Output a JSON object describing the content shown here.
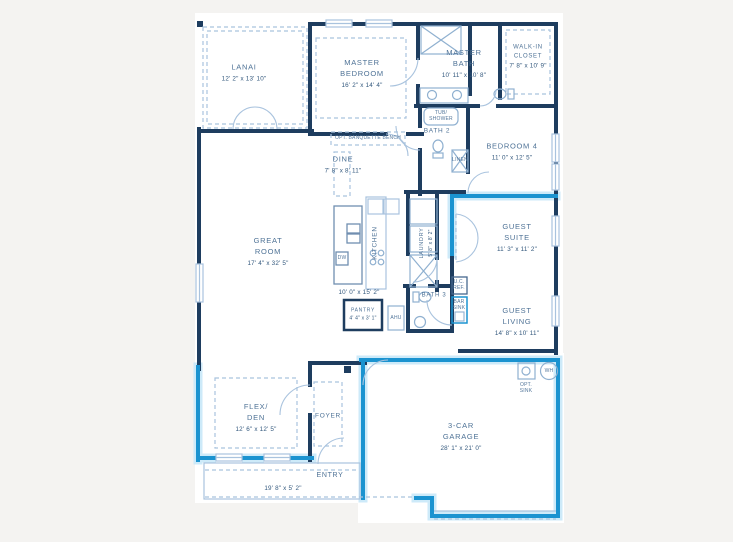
{
  "title": "Floor plan",
  "colors": {
    "wall": "#1e3d5f",
    "optional_wall_accent": "#1b93d0",
    "optional_wall_halo": "#cdeaf9",
    "detail_line": "#a9c3de",
    "room_text": "#4e7296",
    "dims_text": "#33587d",
    "page_background": "#f4f3f1",
    "paper": "#ffffff"
  },
  "rooms": {
    "lanai": {
      "name": "LANAI",
      "dims": "12' 2\" x 13' 10\""
    },
    "master_bedroom": {
      "name": "MASTER\nBEDROOM",
      "dims": "16' 2\" x 14' 4\""
    },
    "master_bath": {
      "name": "MASTER\nBATH",
      "dims": "10' 11\" x 10' 8\""
    },
    "walk_in_closet": {
      "name": "WALK-IN\nCLOSET",
      "dims": "7' 8\" x 10' 9\""
    },
    "bath2": {
      "name": "BATH 2"
    },
    "bedroom4": {
      "name": "BEDROOM 4",
      "dims": "11' 0\" x 12' 5\""
    },
    "dine": {
      "name": "DINE",
      "dims": "7' 8\" x 8' 11\""
    },
    "great_room": {
      "name": "GREAT\nROOM",
      "dims": "17' 4\" x 32' 5\""
    },
    "kitchen": {
      "name": "KITCHEN",
      "dims": "10' 0\" x 15' 2\""
    },
    "laundry": {
      "name": "LAUNDRY",
      "dims": "5' 8\" x 8' 2\""
    },
    "guest_suite": {
      "name": "GUEST\nSUITE",
      "dims": "11' 3\" x 11' 2\""
    },
    "guest_living": {
      "name": "GUEST\nLIVING",
      "dims": "14' 8\" x 10' 11\""
    },
    "bath3": {
      "name": "BATH 3"
    },
    "pantry": {
      "name": "PANTRY",
      "dims": "4' 4\" x 3' 1\""
    },
    "flex_den": {
      "name": "FLEX/\nDEN",
      "dims": "12' 6\" x 12' 5\""
    },
    "foyer": {
      "name": "FOYER"
    },
    "entry": {
      "name": "ENTRY",
      "dims": "19' 8\" x 5' 2\""
    },
    "garage": {
      "name": "3-CAR\nGARAGE",
      "dims": "28' 1\" x 21' 0\""
    }
  },
  "small_labels": {
    "opt_banquette": "OPT. BANQUETTE BENCH",
    "tub_shower": "TUB/\nSHOWER",
    "linen": "LINEN",
    "dw": "DW",
    "uc_ref": "U.C.\nREF.",
    "bar_sink": "BAR\nSINK",
    "ahu": "AHU",
    "opt_sink": "OPT.\nSINK",
    "wh": "WH"
  }
}
